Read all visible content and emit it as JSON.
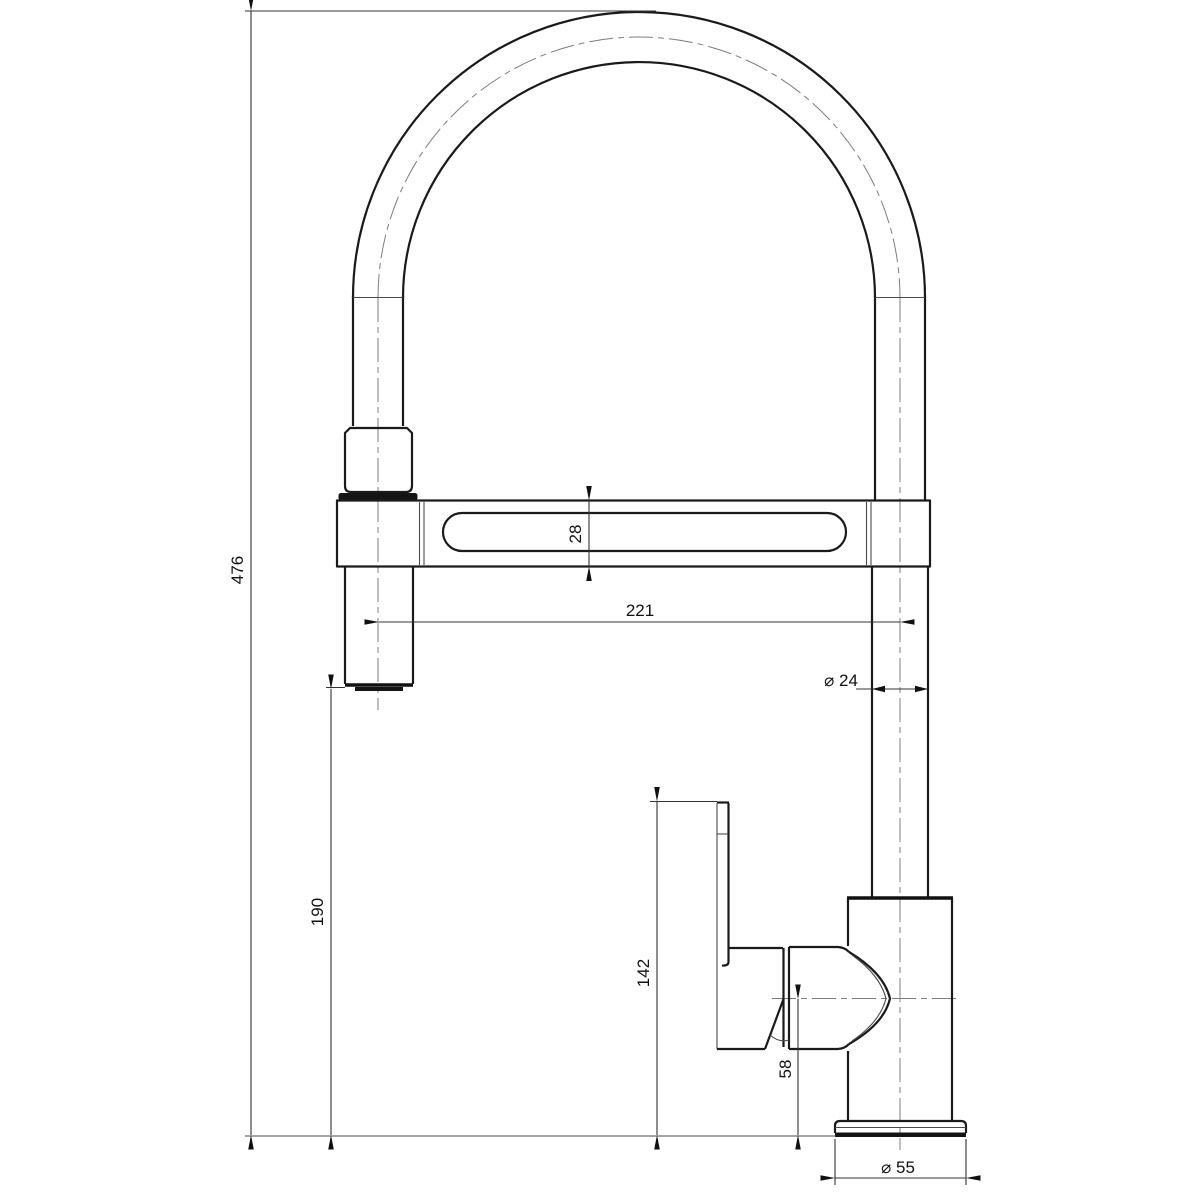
{
  "drawing": {
    "subject": "Kitchen faucet with pull-down spray head - dimensioned side elevation",
    "background_color": "#ffffff",
    "line_color": "#1a1a1a",
    "dimension_labels": {
      "overall_height": "476",
      "spout_bar_height": "28",
      "spout_reach": "221",
      "riser_diameter": "⌀ 24",
      "spray_outlet_clearance": "190",
      "handle_top_height": "142",
      "valve_axis_height": "58",
      "base_diameter": "⌀ 55"
    }
  }
}
